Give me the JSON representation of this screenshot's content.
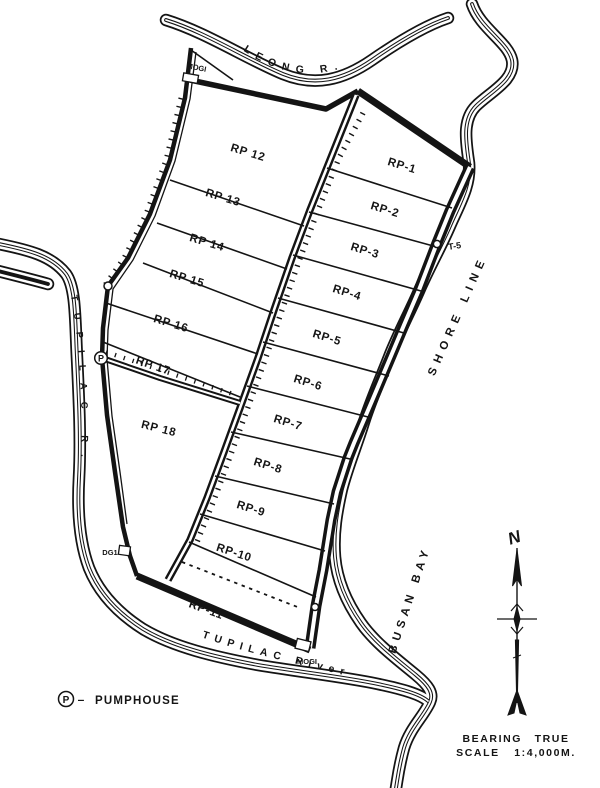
{
  "map": {
    "parcels": [
      {
        "label": "RP 12"
      },
      {
        "label": "RP 13"
      },
      {
        "label": "RP 14"
      },
      {
        "label": "RP 15"
      },
      {
        "label": "RP 16"
      },
      {
        "label": "RP 17"
      },
      {
        "label": "RP 18"
      },
      {
        "label": "RP-1"
      },
      {
        "label": "RP-2"
      },
      {
        "label": "RP-3"
      },
      {
        "label": "RP-4"
      },
      {
        "label": "RP-5"
      },
      {
        "label": "RP-6"
      },
      {
        "label": "RP-7"
      },
      {
        "label": "RP-8"
      },
      {
        "label": "RP-9"
      },
      {
        "label": "RP-10"
      },
      {
        "label": "RP-11"
      }
    ],
    "rivers": {
      "leong": "LEONG R.",
      "tupilac_left": "TUPILAC R.",
      "tupilac_bottom": "TUPILAC River"
    },
    "shore_label": "SHORE LINE",
    "bay_label": "BUSAN BAY",
    "markers": {
      "t5": "T-5",
      "mogi_top": "MOGI",
      "mogi_bottom": "MOGI",
      "dg1": "DG1",
      "pump_symbol": "P"
    },
    "legend": {
      "symbol": "P",
      "separator": "–",
      "label": "PUMPHOUSE"
    },
    "compass": {
      "north": "N"
    },
    "notes": {
      "bearing": "BEARING TRUE",
      "scale": "SCALE 1:4,000M."
    },
    "colors": {
      "ink": "#141414",
      "paper": "#ffffff"
    }
  }
}
